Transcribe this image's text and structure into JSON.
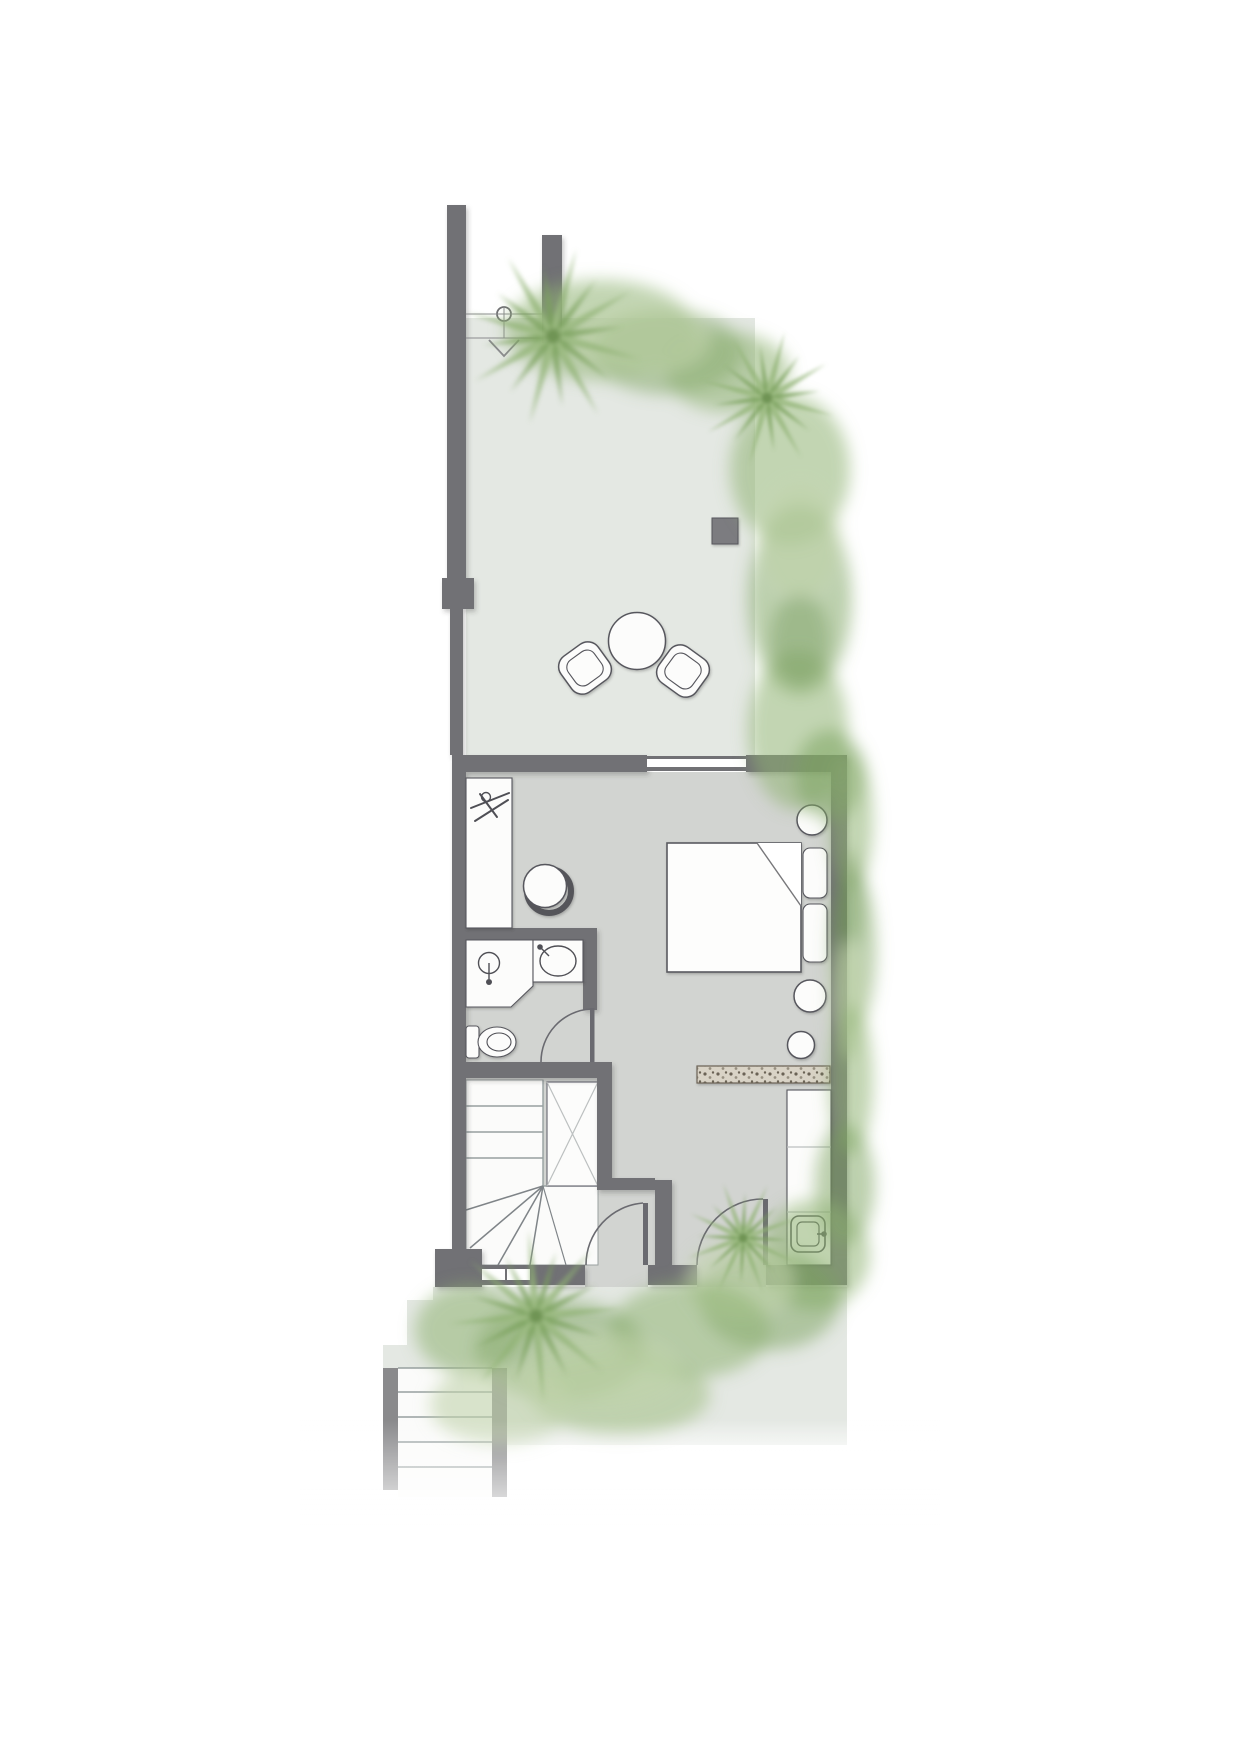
{
  "page": {
    "title": "Floor Plan",
    "background": "#ffffff"
  },
  "plan": {
    "type": "architectural-floor-plan",
    "view": "top-down",
    "rooms": [
      {
        "id": "terrace",
        "label": "Terrace"
      },
      {
        "id": "bedroom",
        "label": "Bedroom"
      },
      {
        "id": "bathroom",
        "label": "Bathroom"
      },
      {
        "id": "stair-hall",
        "label": "Stair hall"
      },
      {
        "id": "garden-path",
        "label": "Garden path"
      }
    ],
    "furniture": [
      {
        "id": "outdoor-table",
        "label": "Round outdoor table"
      },
      {
        "id": "outdoor-chair",
        "label": "Outdoor lounge chair",
        "count": 2
      },
      {
        "id": "planter",
        "label": "Planter box"
      },
      {
        "id": "wardrobe",
        "label": "Open wardrobe with hangers"
      },
      {
        "id": "desk-chair",
        "label": "Tub chair"
      },
      {
        "id": "double-bed",
        "label": "Double bed with two pillows and folded sheet"
      },
      {
        "id": "bedside-table",
        "label": "Round side table",
        "count": 3
      },
      {
        "id": "rug",
        "label": "Pebble-textured runner rug"
      },
      {
        "id": "counter-sink",
        "label": "Counter with square sink"
      }
    ],
    "fixtures": [
      {
        "id": "shower",
        "label": "Corner shower"
      },
      {
        "id": "vanity-basin",
        "label": "Vanity with oval basin"
      },
      {
        "id": "toilet",
        "label": "Toilet"
      }
    ],
    "circulation": [
      {
        "id": "staircase",
        "label": "Staircase with winder treads"
      },
      {
        "id": "stair-closet",
        "label": "Closet beside stairs"
      },
      {
        "id": "entry-door",
        "label": "Entry door"
      },
      {
        "id": "stair-door",
        "label": "Stair hall door"
      },
      {
        "id": "bathroom-door",
        "label": "Bathroom door"
      },
      {
        "id": "garden-gate",
        "label": "Garden gate"
      },
      {
        "id": "entry-steps",
        "label": "Entry steps"
      },
      {
        "id": "window-top",
        "label": "Bedroom window to terrace"
      },
      {
        "id": "window-bottom",
        "label": "Stair window"
      }
    ],
    "landscape": [
      {
        "id": "palm-tree",
        "label": "Palm tree",
        "count": 4
      },
      {
        "id": "hedge",
        "label": "Perimeter hedge planting"
      }
    ]
  },
  "colors": {
    "wall": "#717175",
    "wall_light": "#86868a",
    "outline": "#57575d",
    "floor": "#d2d4d1",
    "paving": "#e4e8e3",
    "fixture": "#fcfcfb",
    "tread_line": "#97a0a0",
    "closet_line": "#bcc0c0",
    "rug_base": "#d9d3c6",
    "rug_dot": "#6b6254",
    "planter": "#7c7c80",
    "door": "#6a6a70",
    "green_dark": "#6f9454",
    "green_mid": "#8fb272",
    "green_deep": "#7aa15d",
    "green_light": "#a5c28b",
    "green_pale": "#c2d3ab",
    "steps_rail": "#8a8a8c",
    "gate_line": "#8a8a8e"
  }
}
